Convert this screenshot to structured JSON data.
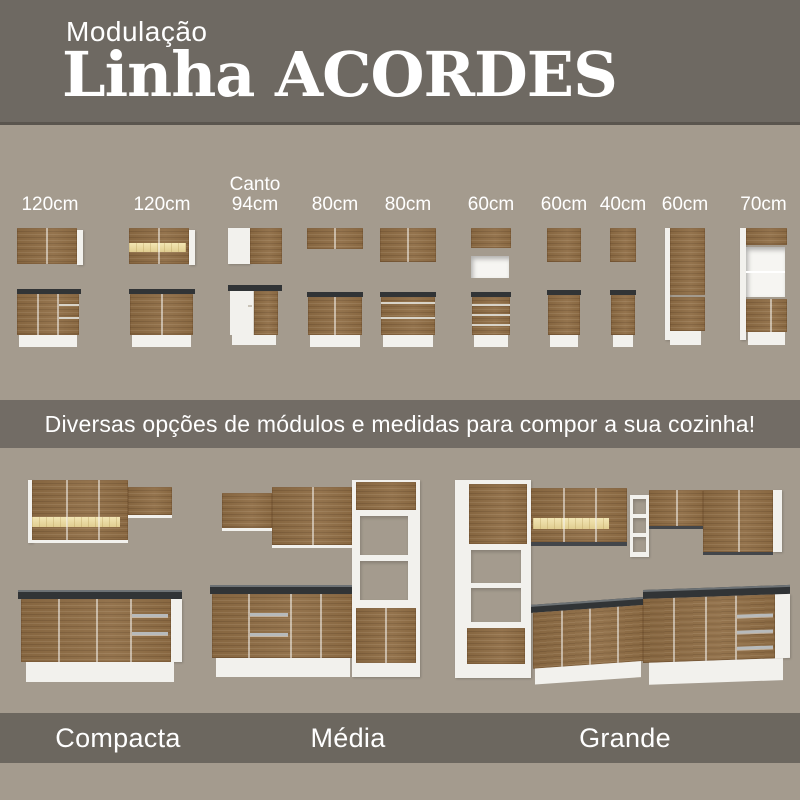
{
  "header": {
    "subtitle": "Modulação",
    "title": "Linha ACORDES"
  },
  "modules": {
    "items": [
      {
        "sublabel": "",
        "label": "120cm",
        "graphic": "wall-cabinet-2-doors + base-cabinet-doors-and-drawers"
      },
      {
        "sublabel": "",
        "label": "120cm",
        "graphic": "wall-cabinet-glass-light-strip + base-cabinet-2-doors"
      },
      {
        "sublabel": "Canto",
        "label": "94cm",
        "graphic": "corner-wall-cabinet + corner-base-cabinet"
      },
      {
        "sublabel": "",
        "label": "80cm",
        "graphic": "low-wall-cabinet + base-cabinet-2-doors"
      },
      {
        "sublabel": "",
        "label": "80cm",
        "graphic": "wall-cabinet-2-doors + base-cabinet-2-drawers"
      },
      {
        "sublabel": "",
        "label": "60cm",
        "graphic": "low-wall-cabinet-with-open-niche + base-drawer-unit"
      },
      {
        "sublabel": "",
        "label": "60cm",
        "graphic": "wall-cabinet-1-door + base-cabinet-1-door"
      },
      {
        "sublabel": "",
        "label": "40cm",
        "graphic": "narrow-wall-cabinet + narrow-base-cabinet"
      },
      {
        "sublabel": "",
        "label": "60cm",
        "graphic": "tall-pantry-cabinet"
      },
      {
        "sublabel": "",
        "label": "70cm",
        "graphic": "tall-cabinet-with-open-niches"
      }
    ]
  },
  "banner": {
    "text": "Diversas opções de módulos e medidas para compor a sua cozinha!"
  },
  "kitchens": {
    "items": [
      {
        "label": "Compacta",
        "graphic": "compact-kitchen-wall-unit-and-counter"
      },
      {
        "label": "Média",
        "graphic": "medium-straight-kitchen-with-tall-tower"
      },
      {
        "label": "Grande",
        "graphic": "large-l-shaped-corner-kitchen"
      }
    ]
  },
  "colors": {
    "background_dark": "#6E6962",
    "background_light": "#A49B8E",
    "banner_dark": "#726C65",
    "band_dark": "#6C675F",
    "wood": "#8E6C44",
    "countertop": "#313436",
    "cabinet_white": "#F2F1ED",
    "glass_light": "#EBD9A4",
    "text": "#FFFFFF"
  }
}
